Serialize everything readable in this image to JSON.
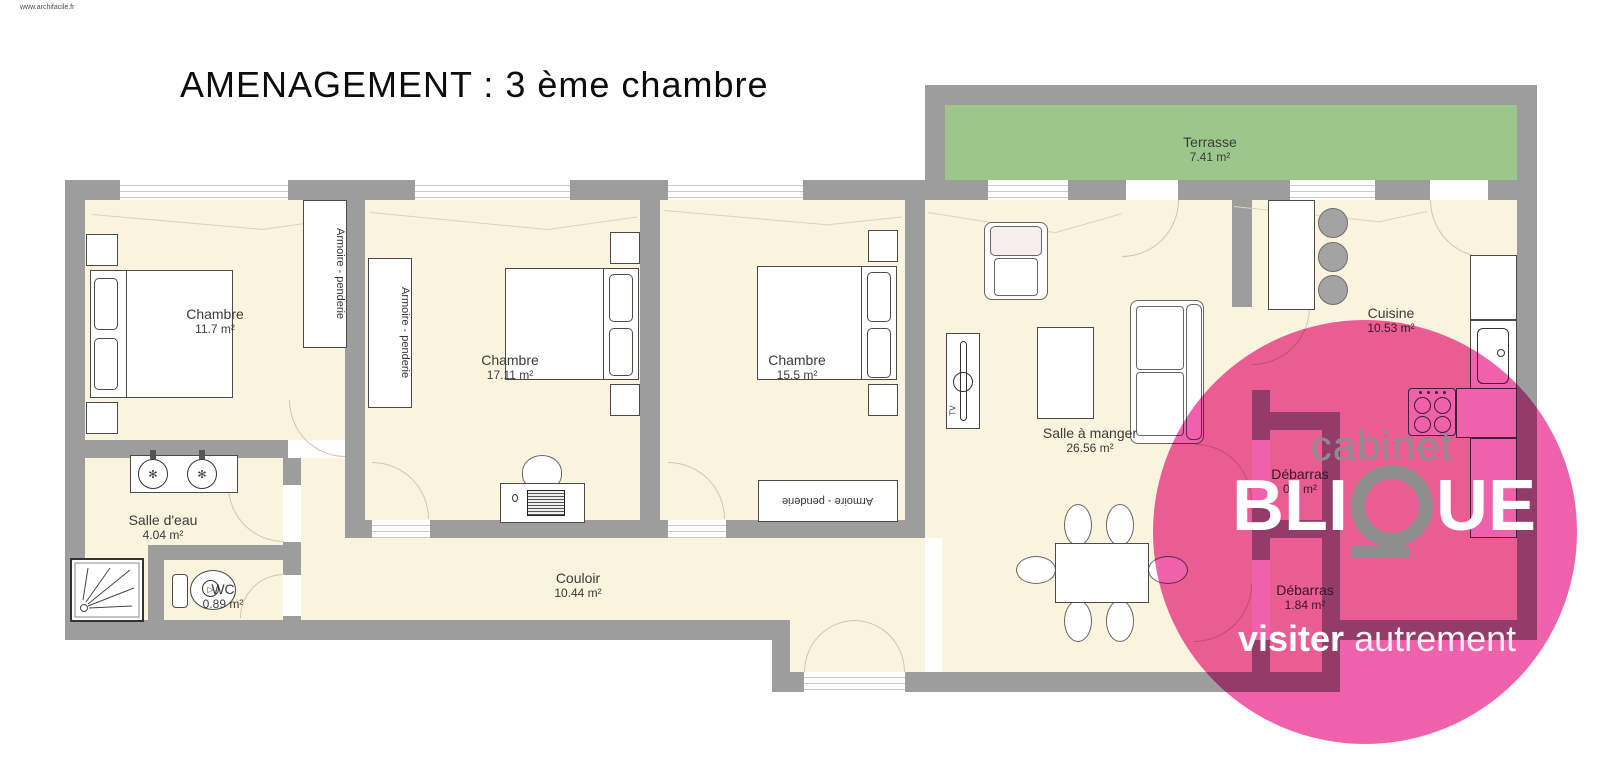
{
  "page": {
    "watermark": "www.archifacile.fr",
    "title": "AMENAGEMENT : 3 ème chambre"
  },
  "rooms": [
    {
      "id": "chambre-1",
      "name": "Chambre",
      "area": "11.7 m²"
    },
    {
      "id": "chambre-2",
      "name": "Chambre",
      "area": "17.11 m²"
    },
    {
      "id": "chambre-3",
      "name": "Chambre",
      "area": "15.5 m²"
    },
    {
      "id": "terrasse",
      "name": "Terrasse",
      "area": "7.41 m²"
    },
    {
      "id": "salle-a-manger",
      "name": "Salle à manger",
      "area": "26.56 m²"
    },
    {
      "id": "cuisine",
      "name": "Cuisine",
      "area": "10.53 m²"
    },
    {
      "id": "salle-deau",
      "name": "Salle d'eau",
      "area": "4.04 m²"
    },
    {
      "id": "wc",
      "name": "WC",
      "area": "0.89 m²"
    },
    {
      "id": "couloir",
      "name": "Couloir",
      "area": "10.44 m²"
    },
    {
      "id": "debarras-1",
      "name": "Débarras",
      "area": "0.9 m²"
    },
    {
      "id": "debarras-2",
      "name": "Débarras",
      "area": "1.84 m²"
    }
  ],
  "furniture_labels": {
    "wardrobe": "Armoire - penderie",
    "tv": "TV"
  },
  "logo": {
    "top_word": "cabinet",
    "brand": "BLIQUE",
    "brand_left": "BLI",
    "brand_right": "UE",
    "tagline_bold": "visiter",
    "tagline_light": "autrement"
  },
  "colors": {
    "wall": "#9d9d9d",
    "floor": "#faf3dd",
    "terrace": "#9bc78a",
    "watermark_pink": "#ee57a5",
    "logo_gray": "#8d8d8d"
  }
}
